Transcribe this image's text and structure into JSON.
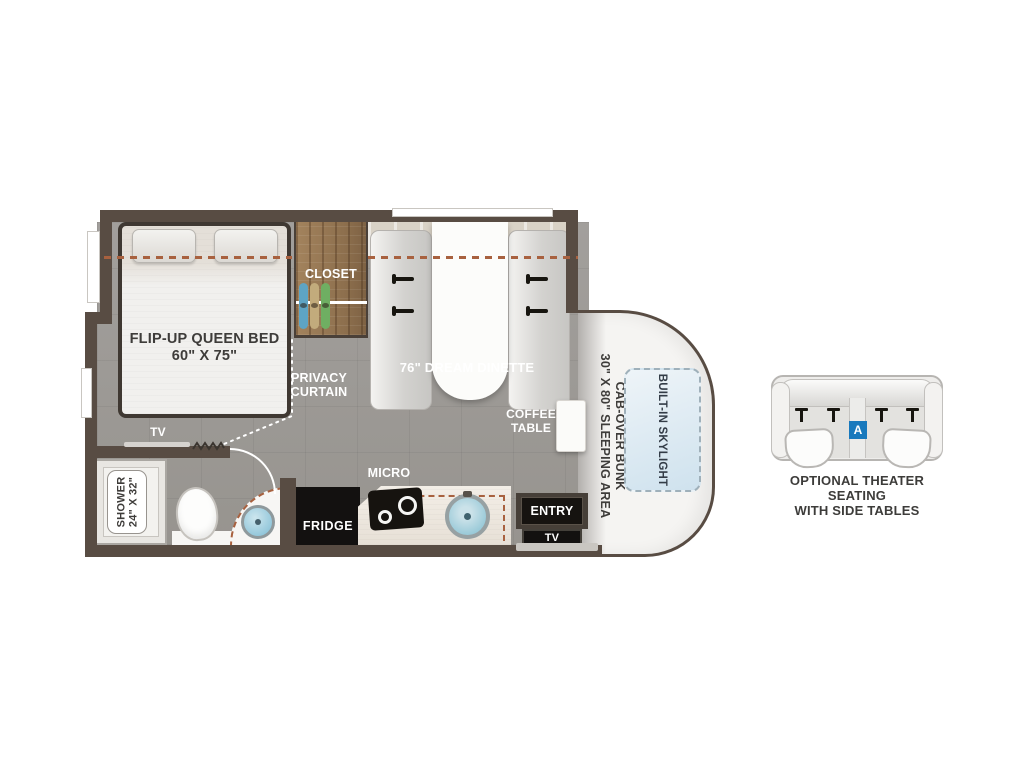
{
  "floorplan": {
    "bedroom": {
      "bed_label": "FLIP-UP QUEEN BED\n60\" X 75\"",
      "tv_label": "TV",
      "closet_label": "CLOSET",
      "privacy_label": "PRIVACY\nCURTAIN"
    },
    "dinette": {
      "label": "76\" DREAM DINETTE",
      "coffee_table_label": "COFFEE\nTABLE"
    },
    "bathroom": {
      "shower_label": "SHOWER\n24\" X 32\""
    },
    "kitchen": {
      "micro_label": "MICRO",
      "fridge_label": "FRIDGE"
    },
    "entry": {
      "door_label": "ENTRY",
      "tv_label": "TV"
    },
    "cab": {
      "bunk_label": "CAB-OVER BUNK\n30\" X 80\" SLEEPING AREA",
      "skylight_label": "BUILT-IN SKYLIGHT"
    }
  },
  "options": {
    "theater": {
      "badge": "A",
      "caption": "OPTIONAL THEATER SEATING\nWITH SIDE TABLES"
    }
  },
  "colors": {
    "wall": "#584c43",
    "floor": "#9e9b98",
    "slide_dash": "#a8613f",
    "closet_wood": "#9c7a55",
    "sink_teal": "#9ccbd9",
    "badge_blue": "#1879bd",
    "cab_body": "#f5f4f2"
  }
}
